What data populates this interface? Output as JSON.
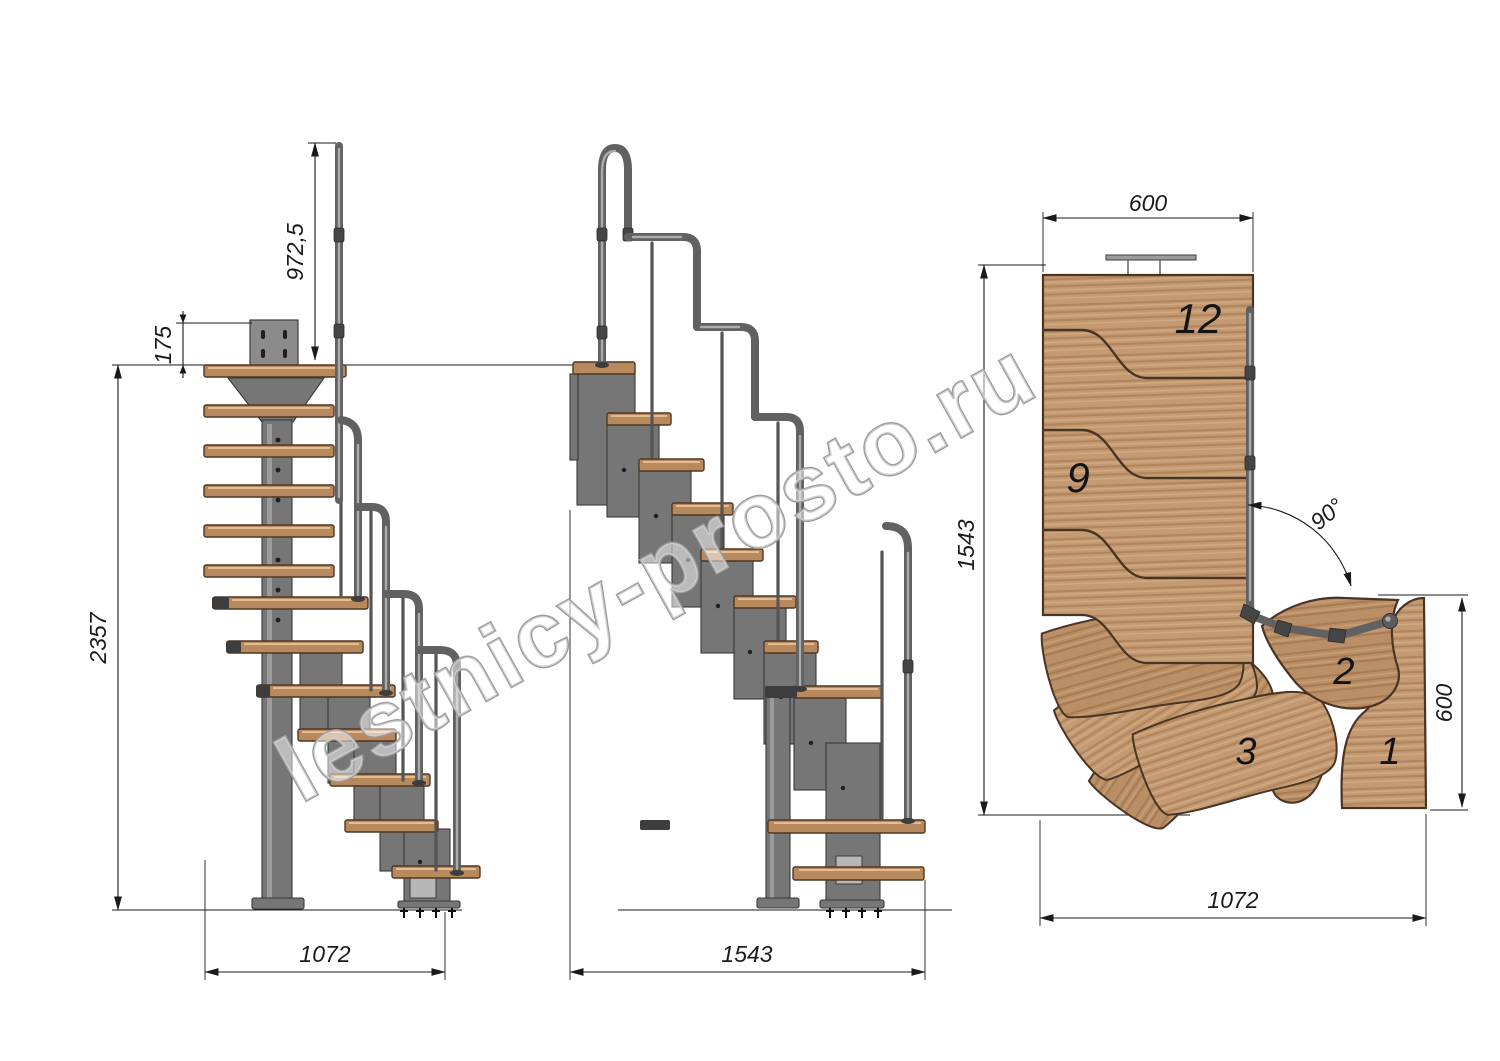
{
  "watermark": "lestnicy-prosto.ru",
  "views": {
    "side": {
      "rail_height": "972,5",
      "top_offset": "175",
      "total_height": "2357",
      "run": "1072"
    },
    "front": {
      "width": "1543"
    },
    "plan": {
      "top_width": "600",
      "depth": "1543",
      "angle": "90°",
      "entry_width": "600",
      "run": "1072",
      "steps": {
        "s12": "12",
        "s9": "9",
        "s3": "3",
        "s2": "2",
        "s1": "1"
      }
    }
  },
  "colors": {
    "line": "#1a1a1a",
    "tread": "#b9895e",
    "wood": "#c49a72",
    "wood_dark": "#b88d63",
    "metal": "#767676",
    "watermark": "#9c9c9c"
  }
}
